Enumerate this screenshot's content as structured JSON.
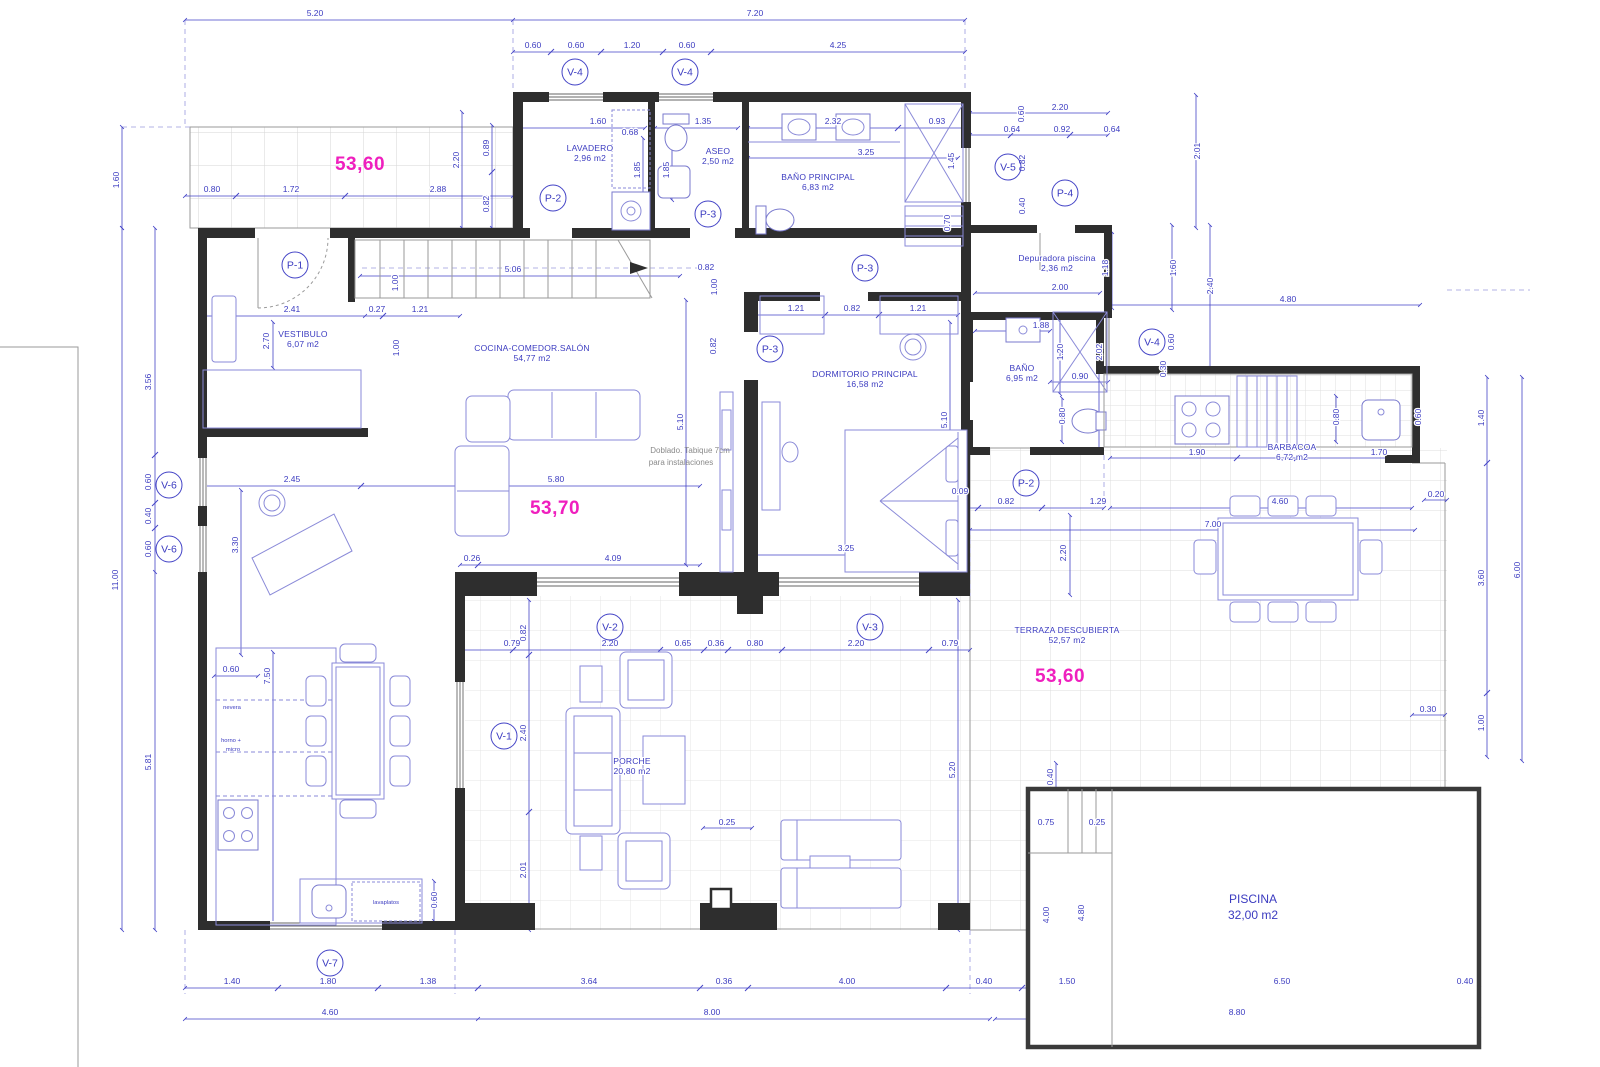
{
  "palette": {
    "wall": "#2e2e2e",
    "pen_blue": "#4343c6",
    "magenta": "#ef1fbe",
    "grid": "#dcdcdc"
  },
  "drawing": {
    "type": "floor-plan"
  },
  "area_marks": [
    "53,60",
    "53,70",
    "53,60"
  ],
  "note": {
    "line1": "Doblado. Tabique 7cm",
    "line2": "para instalaciones"
  },
  "rooms": [
    {
      "name": "LAVADERO",
      "area": "2,96 m2"
    },
    {
      "name": "ASEO",
      "area": "2,50 m2"
    },
    {
      "name": "BAÑO PRINCIPAL",
      "area": "6,83 m2"
    },
    {
      "name": "VESTIBULO",
      "area": "6,07 m2"
    },
    {
      "name": "COCINA-COMEDOR.SALÓN",
      "area": "54,77 m2"
    },
    {
      "name": "DORMITORIO PRINCIPAL",
      "area": "16,58 m2"
    },
    {
      "name": "BAÑO",
      "area": "6,95 m2"
    },
    {
      "name": "Depuradora piscina",
      "area": "2,36 m2"
    },
    {
      "name": "BARBACOA",
      "area": "6,72 m2"
    },
    {
      "name": "TERRAZA DESCUBIERTA",
      "area": "52,57 m2"
    },
    {
      "name": "PORCHE",
      "area": "20,80 m2"
    },
    {
      "name": "PISCINA",
      "area": "32,00 m2"
    }
  ],
  "tags": [
    "V-4",
    "V-4",
    "V-5",
    "P-4",
    "P-2",
    "P-3",
    "P-3",
    "P-1",
    "P-3",
    "P-2",
    "V-4",
    "V-6",
    "V-6",
    "V-2",
    "V-3",
    "V-1",
    "V-7"
  ],
  "labels": {
    "nevera": "nevera",
    "horno": "horno +",
    "micro": "micro",
    "lavaplatos": "lavaplatos"
  },
  "dims": {
    "top": [
      "5.20",
      "7.20",
      "0.60",
      "0.60",
      "1.20",
      "0.60",
      "4.25"
    ],
    "nw": [
      "1.60",
      "0.80",
      "1.72",
      "2.88",
      "2.20",
      "0.89",
      "0.82"
    ],
    "utility": [
      "1.60",
      "0.68",
      "1.35",
      "1.85",
      "1.85",
      "2.32",
      "0.93",
      "3.25",
      "1.45",
      "0.70"
    ],
    "annex": [
      "2.20",
      "0.64",
      "0.92",
      "0.64",
      "0.60",
      "0.82",
      "0.40",
      "2.01",
      "2.00",
      "1.18",
      "1.60",
      "2.40"
    ],
    "right": [
      "4.80",
      "0.60",
      "0.30",
      "1.40",
      "3.60",
      "6.00",
      "1.00",
      "0.30",
      "0.20"
    ],
    "bano2": [
      "1.88",
      "1.20",
      "2.02",
      "0.90",
      "0.80"
    ],
    "barb": [
      "1.90",
      "0.80",
      "0.60",
      "1.70"
    ],
    "terr": [
      "0.09",
      "0.82",
      "1.29",
      "2.20",
      "4.60",
      "7.00"
    ],
    "dorm": [
      "1.21",
      "0.82",
      "1.21",
      "5.10",
      "3.25",
      "0.82",
      "1.00",
      "0.82"
    ],
    "stairs": [
      "5.06",
      "1.00",
      "0.27",
      "1.21",
      "1.00"
    ],
    "vest": [
      "2.41",
      "2.70",
      "3.56"
    ],
    "left": [
      "11.00",
      "0.60",
      "0.40",
      "0.60",
      "5.81"
    ],
    "salon": [
      "2.45",
      "3.30",
      "5.80",
      "0.26",
      "4.09",
      "5.10"
    ],
    "kitchen": [
      "0.60",
      "7.50",
      "0.60"
    ],
    "porch": [
      "0.79",
      "2.20",
      "0.65",
      "0.36",
      "0.80",
      "2.20",
      "0.79",
      "0.82",
      "2.40",
      "2.01",
      "5.20",
      "0.25"
    ],
    "pool": [
      "0.75",
      "0.25",
      "0.40",
      "4.00",
      "4.80"
    ],
    "bottom": [
      "1.40",
      "1.80",
      "1.38",
      "3.64",
      "0.36",
      "4.00",
      "0.40",
      "1.50",
      "6.50",
      "0.40",
      "4.60",
      "8.00",
      "8.80"
    ]
  }
}
